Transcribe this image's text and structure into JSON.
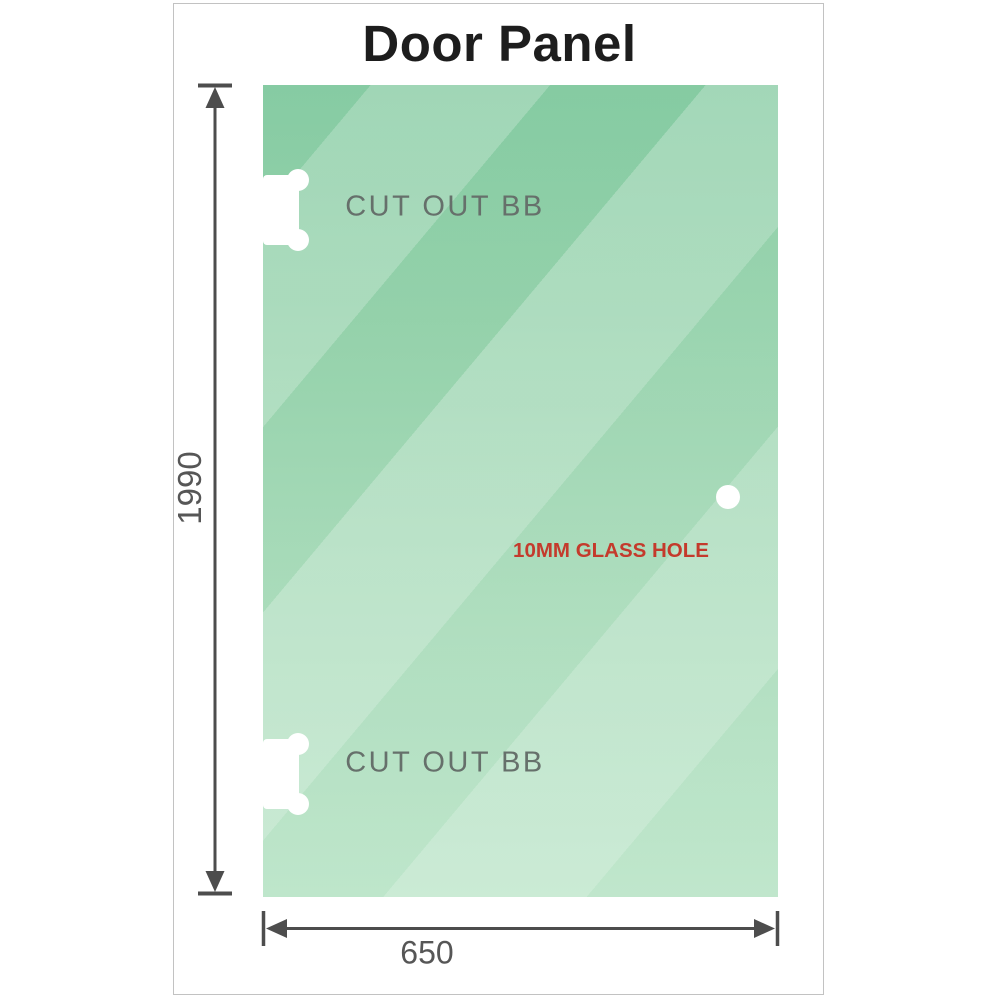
{
  "title": "Door Panel",
  "panel": {
    "cutouts": [
      {
        "label": "CUT OUT BB"
      },
      {
        "label": "CUT OUT BB"
      }
    ],
    "hole": {
      "label": "10MM GLASS HOLE"
    }
  },
  "dimensions": {
    "height": {
      "label": "1990"
    },
    "width": {
      "label": "650"
    }
  },
  "colors": {
    "glass_top": "#7fc89d",
    "glass_bottom": "#b7e3c5",
    "line_gray": "#4d4d4d",
    "dim_text": "#565656",
    "cutout_text": "#66706b",
    "hole_red": "#c43a2c",
    "title_black": "#1d1d1d",
    "card_border": "#c2c2c2"
  }
}
